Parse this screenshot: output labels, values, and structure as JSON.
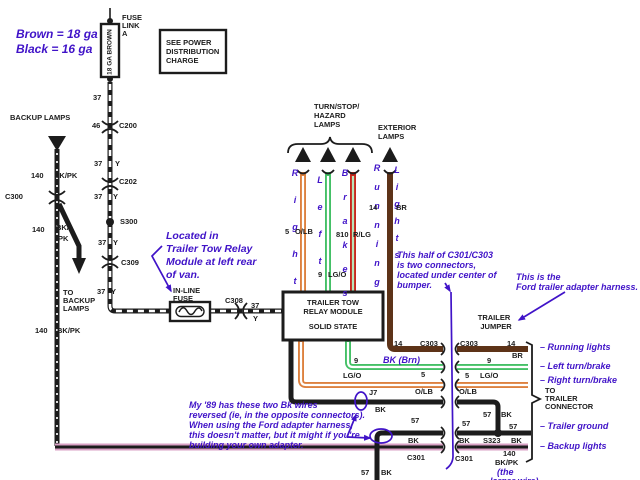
{
  "colors": {
    "black": "#1c1c1c",
    "orange": "#dd813f",
    "green": "#44c066",
    "red": "#c8271c",
    "brown": "#5d3318",
    "pink": "#d9a0c4",
    "purple": "#4013c8"
  },
  "labels": [
    {
      "t": "FUSE",
      "x": 122,
      "y": 13
    },
    {
      "t": "LINK",
      "x": 122,
      "y": 21
    },
    {
      "t": "A",
      "x": 122,
      "y": 29
    },
    {
      "t": "18 GA BROWN",
      "x": 110,
      "y": 52,
      "c": "rot"
    },
    {
      "t": "SEE POWER",
      "x": 166,
      "y": 38
    },
    {
      "t": "DISTRIBUTION",
      "x": 166,
      "y": 47
    },
    {
      "t": "CHARGE",
      "x": 166,
      "y": 56
    },
    {
      "t": "Brown = 18 ga",
      "x": 16,
      "y": 27,
      "c": "ab"
    },
    {
      "t": "Black = 16 ga",
      "x": 16,
      "y": 42,
      "c": "ab"
    },
    {
      "t": "37",
      "x": 93,
      "y": 93
    },
    {
      "t": "46",
      "x": 92,
      "y": 121
    },
    {
      "t": "C200",
      "x": 119,
      "y": 121
    },
    {
      "t": "37",
      "x": 94,
      "y": 159
    },
    {
      "t": "Y",
      "x": 115,
      "y": 159
    },
    {
      "t": "C202",
      "x": 119,
      "y": 177
    },
    {
      "t": "37",
      "x": 94,
      "y": 192
    },
    {
      "t": "Y",
      "x": 113,
      "y": 192
    },
    {
      "t": "S300",
      "x": 120,
      "y": 217
    },
    {
      "t": "37",
      "x": 98,
      "y": 238
    },
    {
      "t": "Y",
      "x": 113,
      "y": 238
    },
    {
      "t": "C309",
      "x": 121,
      "y": 258
    },
    {
      "t": "37",
      "x": 97,
      "y": 287
    },
    {
      "t": "Y",
      "x": 111,
      "y": 287
    },
    {
      "t": "BACKUP LAMPS",
      "x": 10,
      "y": 113
    },
    {
      "t": "140",
      "x": 31,
      "y": 171
    },
    {
      "t": "BK/PK",
      "x": 54,
      "y": 171
    },
    {
      "t": "C300",
      "x": 5,
      "y": 192
    },
    {
      "t": "140",
      "x": 32,
      "y": 225
    },
    {
      "t": "BK/",
      "x": 56,
      "y": 223
    },
    {
      "t": "PK",
      "x": 58,
      "y": 234
    },
    {
      "t": "TO",
      "x": 63,
      "y": 288
    },
    {
      "t": "BACKUP",
      "x": 63,
      "y": 296
    },
    {
      "t": "LAMPS",
      "x": 63,
      "y": 304
    },
    {
      "t": "140",
      "x": 35,
      "y": 326
    },
    {
      "t": "BK/PK",
      "x": 57,
      "y": 326
    },
    {
      "t": "Located in",
      "x": 166,
      "y": 230,
      "c": "al"
    },
    {
      "t": "Trailer Tow Relay",
      "x": 166,
      "y": 243,
      "c": "al"
    },
    {
      "t": "Module at left rear",
      "x": 166,
      "y": 256,
      "c": "al"
    },
    {
      "t": "of van.",
      "x": 166,
      "y": 269,
      "c": "al"
    },
    {
      "t": "IN-LINE",
      "x": 173,
      "y": 286
    },
    {
      "t": "FUSE",
      "x": 173,
      "y": 294
    },
    {
      "t": "C308",
      "x": 225,
      "y": 296
    },
    {
      "t": "37",
      "x": 251,
      "y": 301
    },
    {
      "t": "Y",
      "x": 253,
      "y": 314
    },
    {
      "t": "TURN/STOP/",
      "x": 314,
      "y": 102
    },
    {
      "t": "HAZARD",
      "x": 314,
      "y": 111
    },
    {
      "t": "LAMPS",
      "x": 314,
      "y": 120
    },
    {
      "t": "EXTERIOR",
      "x": 378,
      "y": 123
    },
    {
      "t": "LAMPS",
      "x": 378,
      "y": 132
    },
    {
      "t": "Right",
      "x": 291,
      "y": 160,
      "c": "v",
      "lh": 27
    },
    {
      "t": "Left",
      "x": 316,
      "y": 167,
      "c": "v",
      "lh": 27
    },
    {
      "t": "Brakes",
      "x": 341,
      "y": 161,
      "c": "v",
      "lh": 24
    },
    {
      "t": "Running",
      "x": 373,
      "y": 159,
      "c": "v",
      "lh": 19
    },
    {
      "t": "Lights",
      "x": 393,
      "y": 162,
      "c": "v",
      "lh": 17
    },
    {
      "t": "5",
      "x": 285,
      "y": 227
    },
    {
      "t": "O/LB",
      "x": 295,
      "y": 227
    },
    {
      "t": "810",
      "x": 336,
      "y": 230
    },
    {
      "t": "R/LG",
      "x": 353,
      "y": 230
    },
    {
      "t": "9",
      "x": 318,
      "y": 270
    },
    {
      "t": "LG/O",
      "x": 328,
      "y": 270
    },
    {
      "t": "14",
      "x": 369,
      "y": 203
    },
    {
      "t": "BR",
      "x": 396,
      "y": 203
    },
    {
      "t": "TRAILER TOW",
      "x": 333,
      "y": 298,
      "c": "bc"
    },
    {
      "t": "RELAY MODULE",
      "x": 333,
      "y": 307,
      "c": "bc"
    },
    {
      "t": "SOLID STATE",
      "x": 333,
      "y": 322,
      "c": "bc"
    },
    {
      "t": "This half of C301/C303",
      "x": 397,
      "y": 250,
      "c": "a"
    },
    {
      "t": "is two connectors,",
      "x": 397,
      "y": 260,
      "c": "a"
    },
    {
      "t": "located under center of",
      "x": 397,
      "y": 270,
      "c": "a"
    },
    {
      "t": "bumper.",
      "x": 397,
      "y": 280,
      "c": "a"
    },
    {
      "t": "This is the",
      "x": 516,
      "y": 272,
      "c": "a"
    },
    {
      "t": "Ford trailer adapter harness.",
      "x": 516,
      "y": 282,
      "c": "a"
    },
    {
      "t": "TRAILER",
      "x": 494,
      "y": 313,
      "c": "bc"
    },
    {
      "t": "JUMPER",
      "x": 496,
      "y": 322,
      "c": "bc"
    },
    {
      "t": "14",
      "x": 394,
      "y": 339
    },
    {
      "t": "C303",
      "x": 420,
      "y": 339
    },
    {
      "t": "C303",
      "x": 460,
      "y": 339
    },
    {
      "t": "14",
      "x": 507,
      "y": 339
    },
    {
      "t": "BR",
      "x": 512,
      "y": 351
    },
    {
      "t": "BK (Brn)",
      "x": 383,
      "y": 355,
      "c": "a"
    },
    {
      "t": "9",
      "x": 354,
      "y": 356
    },
    {
      "t": "LG/O",
      "x": 343,
      "y": 371
    },
    {
      "t": "5",
      "x": 421,
      "y": 370
    },
    {
      "t": "O/LB",
      "x": 415,
      "y": 387
    },
    {
      "t": "9",
      "x": 487,
      "y": 356
    },
    {
      "t": "5",
      "x": 465,
      "y": 371
    },
    {
      "t": "LG/O",
      "x": 480,
      "y": 371
    },
    {
      "t": "O/LB",
      "x": 459,
      "y": 387
    },
    {
      "t": "J7",
      "x": 369,
      "y": 388
    },
    {
      "t": "BK",
      "x": 375,
      "y": 405
    },
    {
      "t": "57",
      "x": 483,
      "y": 410
    },
    {
      "t": "BK",
      "x": 501,
      "y": 410
    },
    {
      "t": "57",
      "x": 411,
      "y": 416
    },
    {
      "t": "BK",
      "x": 408,
      "y": 436
    },
    {
      "t": "57",
      "x": 462,
      "y": 419
    },
    {
      "t": "BK",
      "x": 459,
      "y": 436
    },
    {
      "t": "S323",
      "x": 483,
      "y": 436
    },
    {
      "t": "57",
      "x": 509,
      "y": 422
    },
    {
      "t": "BK",
      "x": 511,
      "y": 436
    },
    {
      "t": "C301",
      "x": 407,
      "y": 453
    },
    {
      "t": "C301",
      "x": 455,
      "y": 454
    },
    {
      "t": "140",
      "x": 503,
      "y": 449
    },
    {
      "t": "BK/PK",
      "x": 495,
      "y": 458
    },
    {
      "t": "(the",
      "x": 497,
      "y": 467,
      "c": "a"
    },
    {
      "t": "larger wire)",
      "x": 490,
      "y": 476,
      "c": "a"
    },
    {
      "t": "TO",
      "x": 545,
      "y": 386
    },
    {
      "t": "TRAILER",
      "x": 545,
      "y": 394
    },
    {
      "t": "CONNECTOR",
      "x": 545,
      "y": 402
    },
    {
      "t": "– Running lights",
      "x": 540,
      "y": 342,
      "c": "a"
    },
    {
      "t": "– Left turn/brake",
      "x": 540,
      "y": 361,
      "c": "a"
    },
    {
      "t": "– Right turn/brake",
      "x": 540,
      "y": 375,
      "c": "a"
    },
    {
      "t": "– Trailer ground",
      "x": 540,
      "y": 421,
      "c": "a"
    },
    {
      "t": "– Backup lights",
      "x": 540,
      "y": 441,
      "c": "a"
    },
    {
      "t": "My '89 has these two Bk wires",
      "x": 189,
      "y": 400,
      "c": "a"
    },
    {
      "t": "reversed (ie, in the opposite connectors).",
      "x": 189,
      "y": 410,
      "c": "a"
    },
    {
      "t": "When using the Ford adapter harness,",
      "x": 189,
      "y": 420,
      "c": "a"
    },
    {
      "t": "this doesn't matter, but it might if you're",
      "x": 189,
      "y": 430,
      "c": "a"
    },
    {
      "t": "building your own adapter.",
      "x": 189,
      "y": 440,
      "c": "a"
    },
    {
      "t": "57",
      "x": 361,
      "y": 468
    },
    {
      "t": "BK",
      "x": 381,
      "y": 468
    }
  ]
}
